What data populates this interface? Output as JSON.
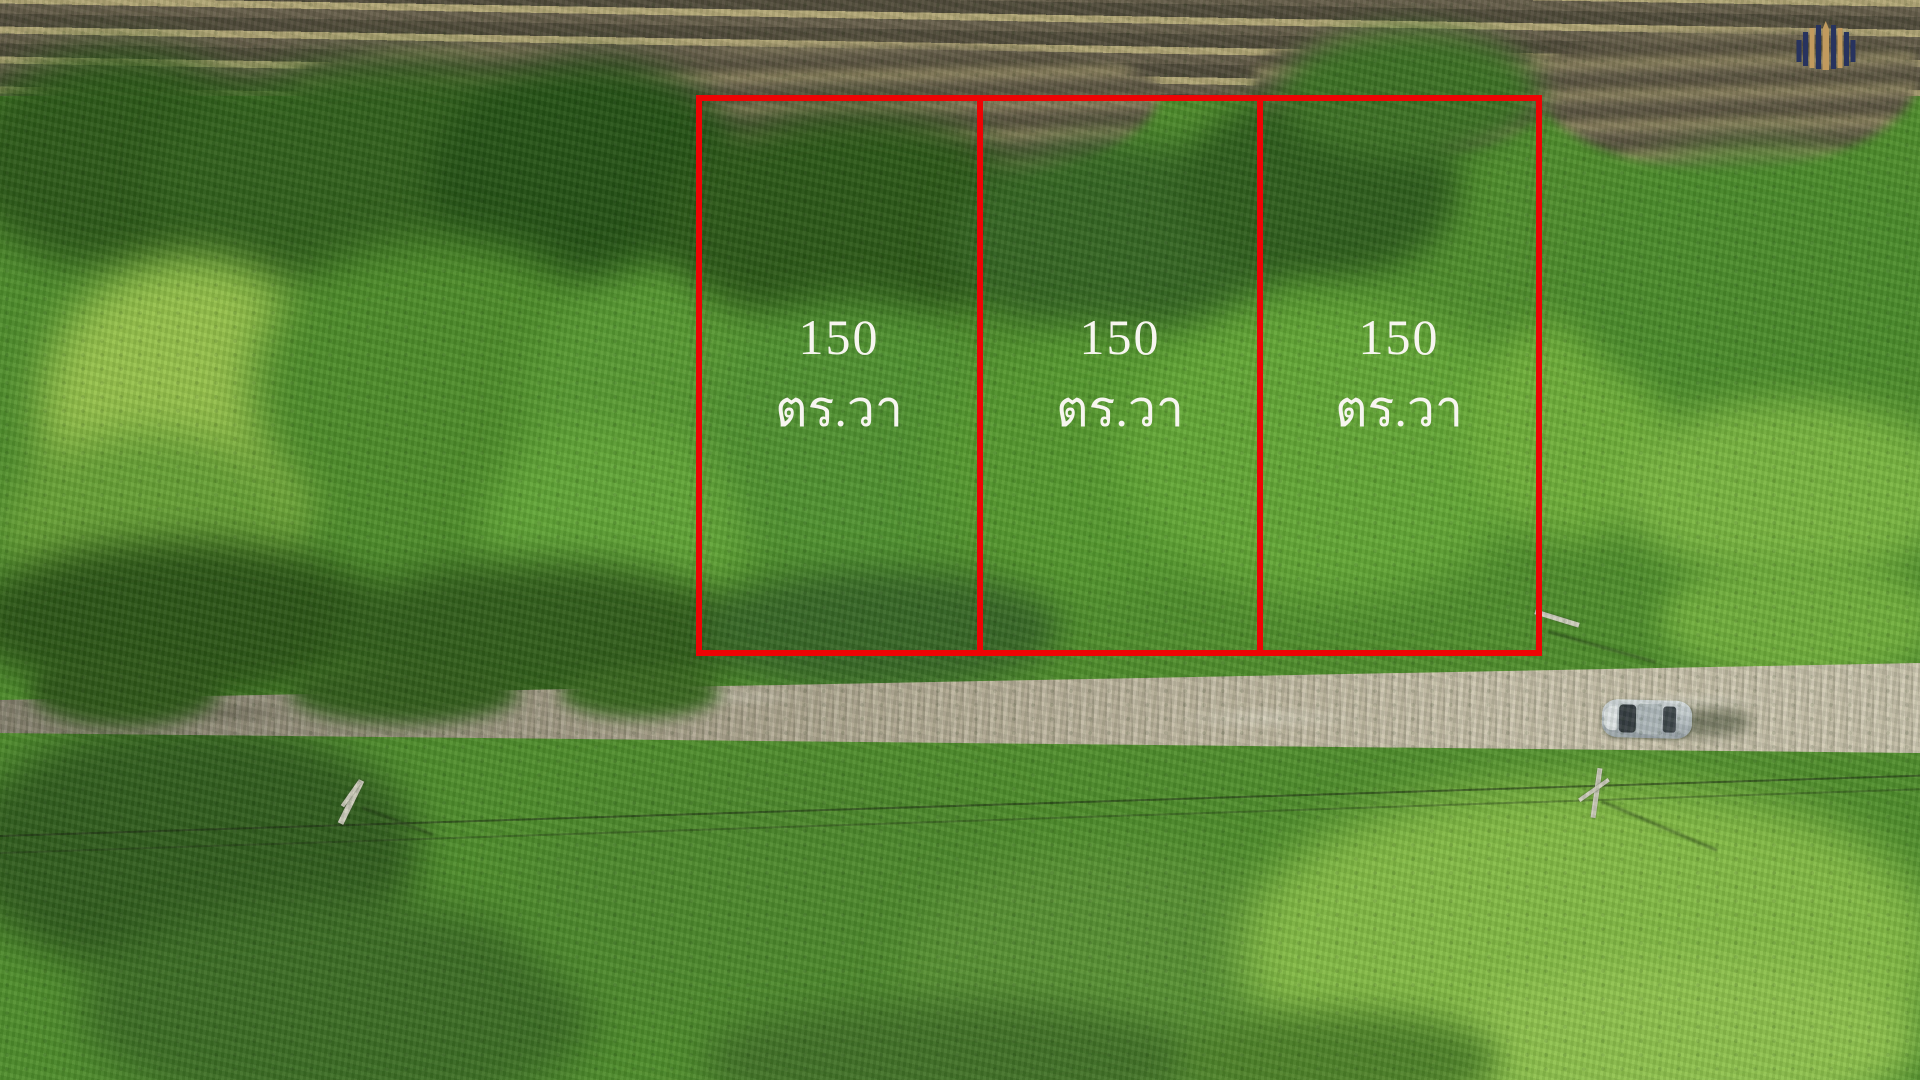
{
  "scene": {
    "type": "aerial-drone-photo-of-land-plots-for-sale",
    "boundary_color": "#ee0404",
    "label_text_color": "#f7f5f0"
  },
  "plots": [
    {
      "area": "150",
      "unit": "ตร.วา"
    },
    {
      "area": "150",
      "unit": "ตร.วา"
    },
    {
      "area": "150",
      "unit": "ตร.วา"
    }
  ],
  "branding": {
    "logo_name": "striped-dome-bars-logo",
    "logo_navy": "#27335f",
    "logo_gold": "#c19a5e"
  }
}
